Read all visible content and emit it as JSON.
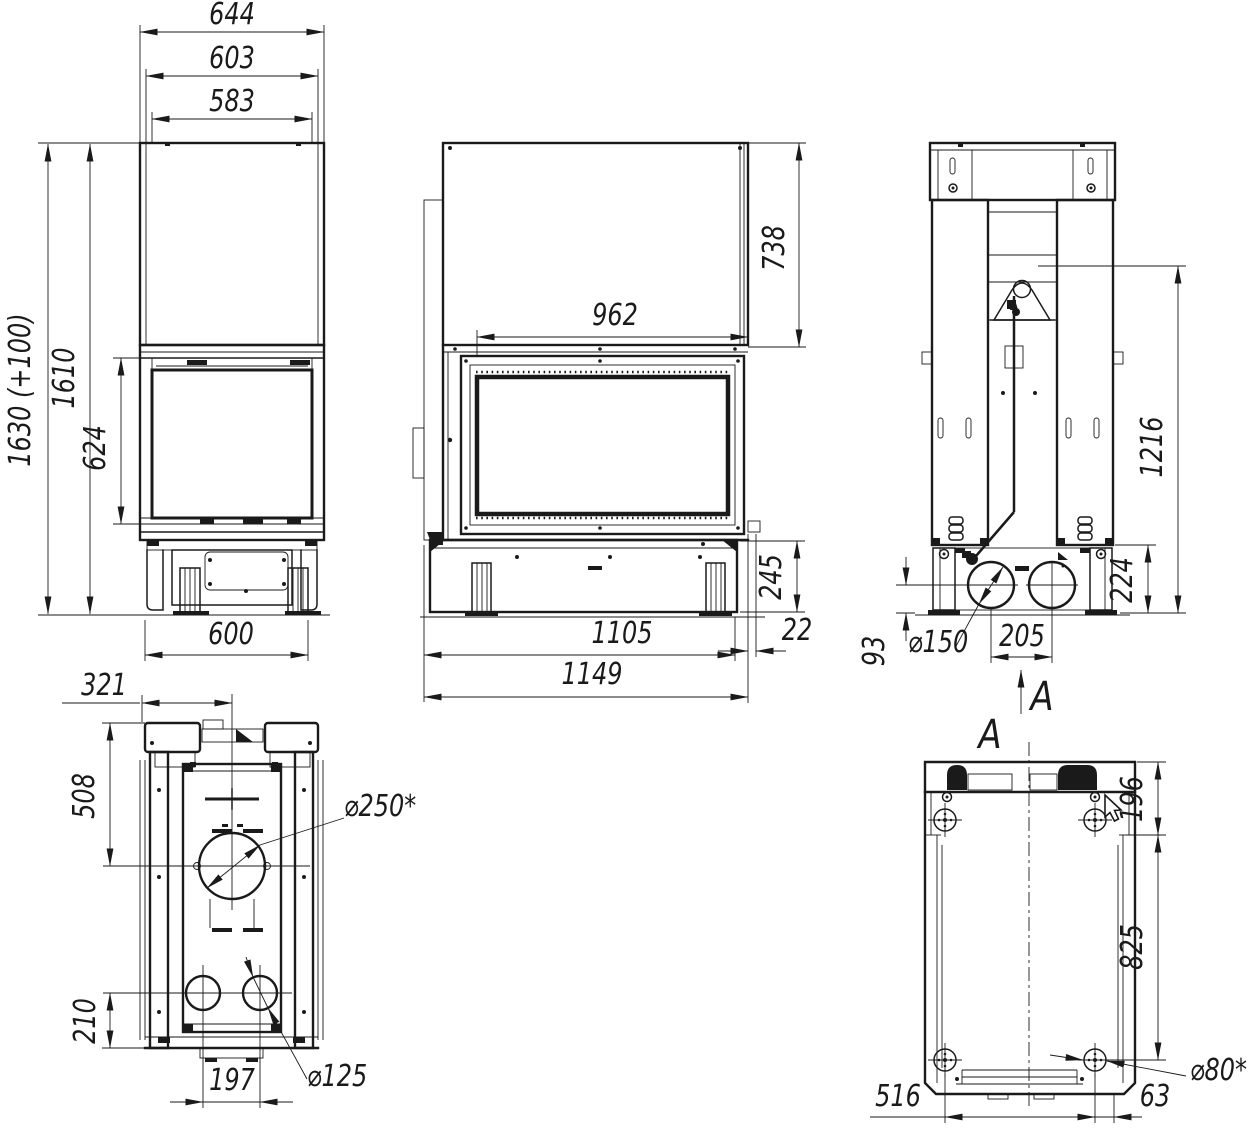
{
  "colors": {
    "ink": "#1a1a1a",
    "paper": "#ffffff"
  },
  "views": {
    "side": {
      "dims": {
        "w_outer": "644",
        "w_mid": "603",
        "w_inner": "583",
        "h_total": "1630 (+100)",
        "h_body": "1610",
        "h_door": "624",
        "w_base": "600"
      }
    },
    "front": {
      "dims": {
        "w_glass": "962",
        "h_hood": "738",
        "h_base": "245",
        "offset_front": "22",
        "w_base": "1105",
        "w_total": "1149"
      }
    },
    "rear": {
      "dims": {
        "h_cable": "1216",
        "h_base": "224",
        "h_outlet": "93",
        "d_outlet": "⌀150",
        "s_outlets": "205"
      },
      "section": {
        "letter": "A"
      }
    },
    "top": {
      "dims": {
        "off_center": "321",
        "depth_glass": "508",
        "d_flue": "⌀250*",
        "h_rear": "210",
        "s_outlets": "197",
        "d_outlet": "⌀125"
      }
    },
    "bottom": {
      "dims": {
        "d_front": "196",
        "d_length": "825",
        "d_wheel": "⌀80*",
        "s_wheels": "516",
        "off_rear": "63"
      },
      "section": {
        "letter": "A"
      }
    }
  }
}
